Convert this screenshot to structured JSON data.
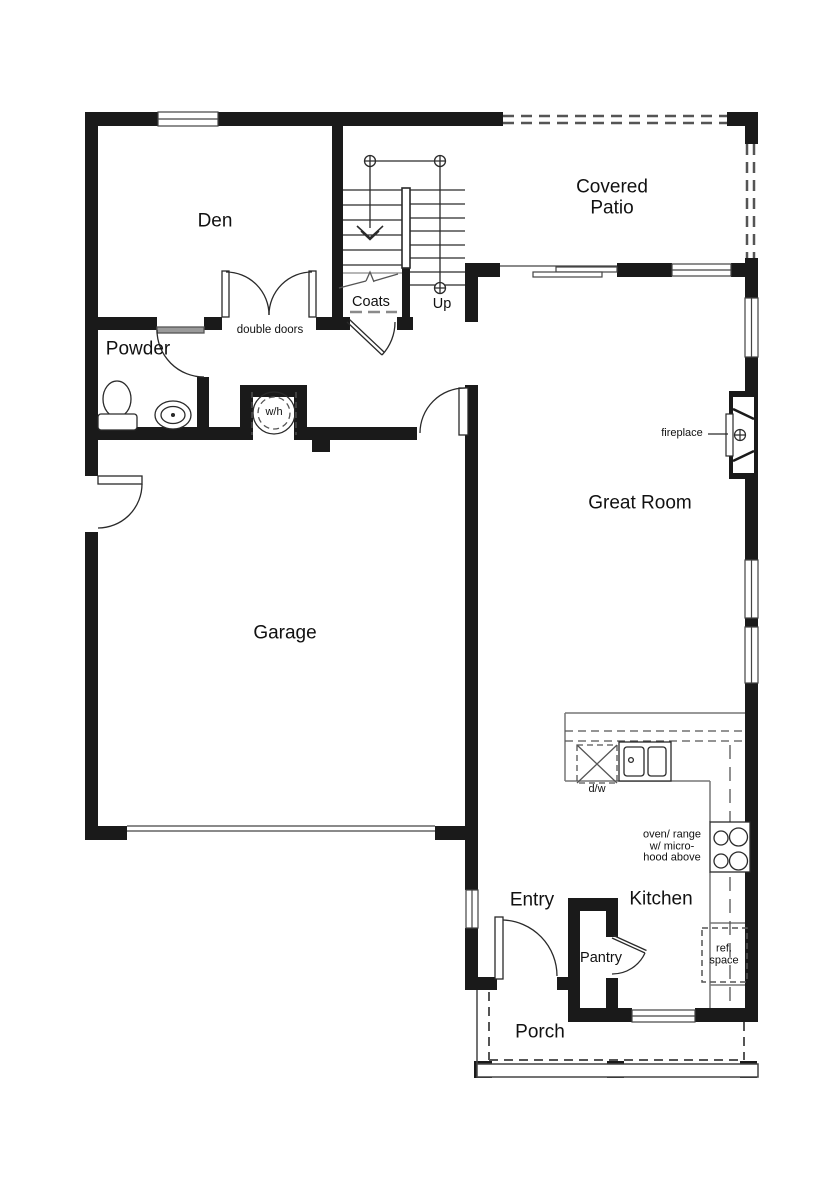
{
  "rooms": {
    "den": "Den",
    "covered_patio": "Covered\nPatio",
    "powder": "Powder",
    "coats": "Coats",
    "great_room": "Great Room",
    "garage": "Garage",
    "entry": "Entry",
    "kitchen": "Kitchen",
    "pantry": "Pantry",
    "porch": "Porch"
  },
  "annotations": {
    "up": "Up",
    "double_doors": "double doors",
    "water_heater": "w/h",
    "fireplace": "fireplace",
    "dishwasher": "d/w",
    "oven_range": "oven/ range\nw/ micro-\nhood above",
    "ref_space": "ref.\nspace"
  },
  "colors": {
    "wall": "#1a1a1a",
    "line": "#2a2a2a",
    "counter": "#777777",
    "dash": "#555555",
    "window": "#444444",
    "bg": "#ffffff",
    "text": "#111111"
  }
}
